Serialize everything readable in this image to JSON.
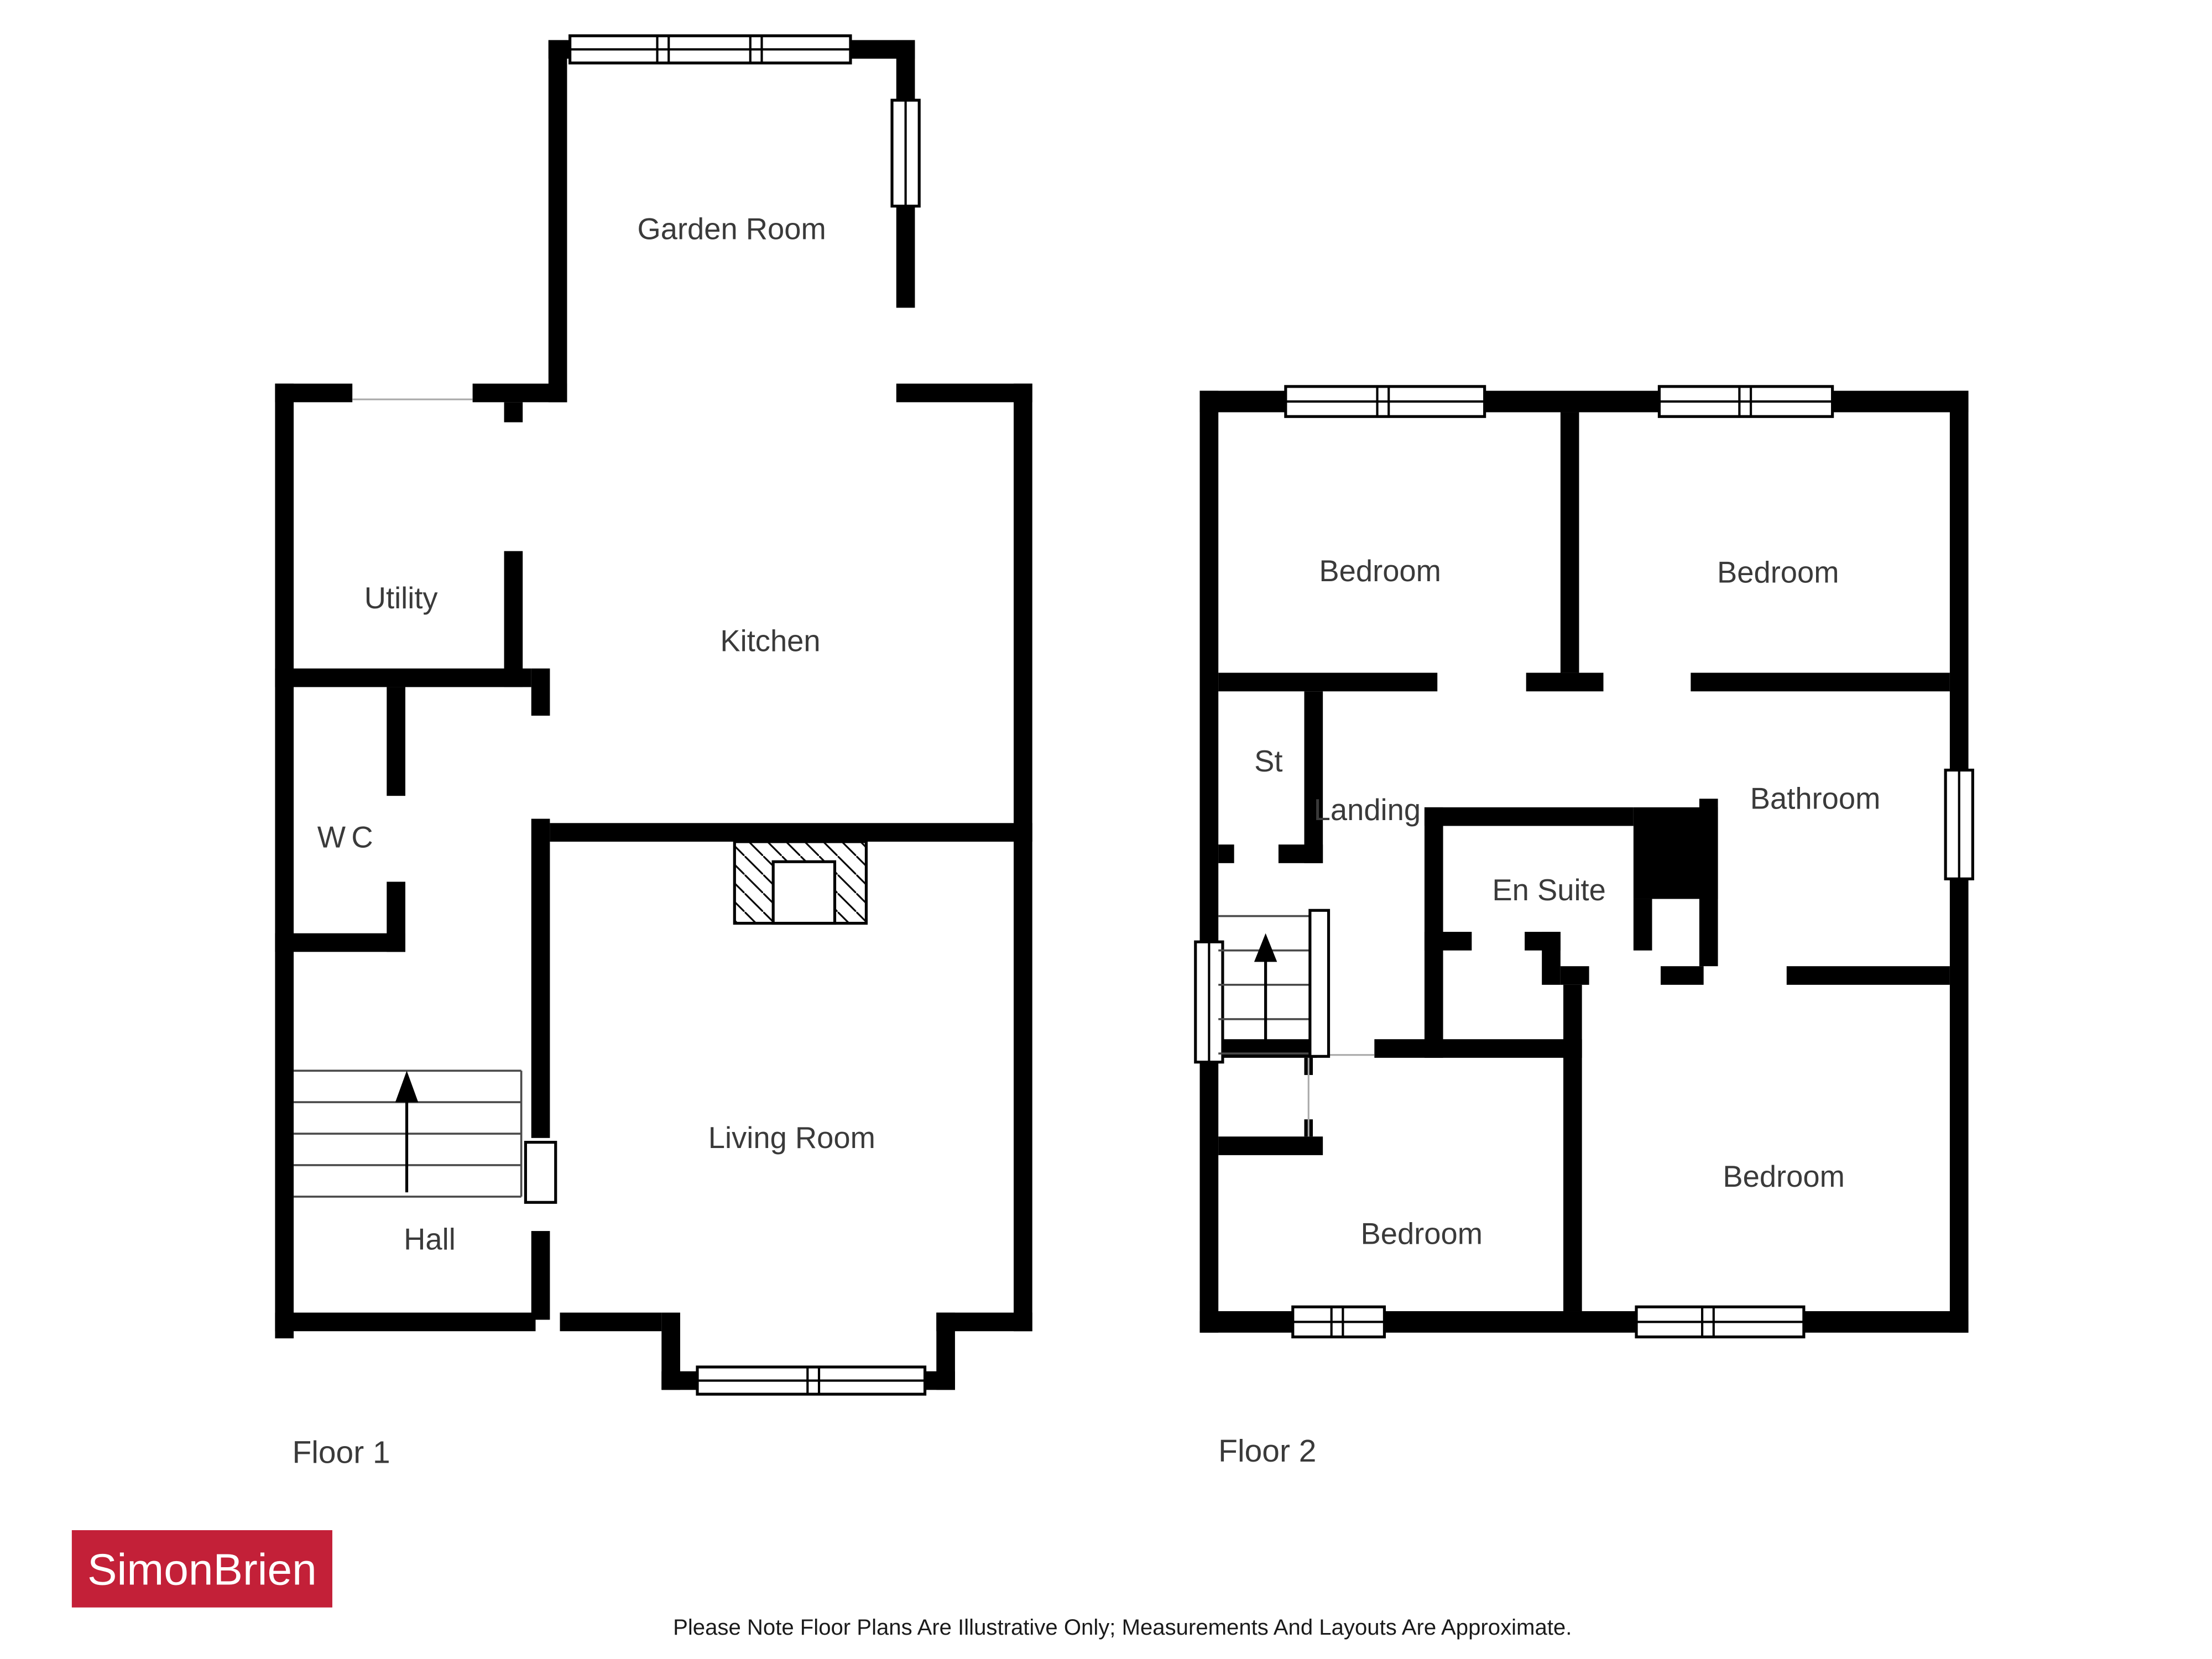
{
  "floor1": {
    "label": "Floor 1",
    "rooms": [
      {
        "name": "Garden Room"
      },
      {
        "name": "Utility"
      },
      {
        "name": "Kitchen"
      },
      {
        "name": "WC"
      },
      {
        "name": "Hall"
      },
      {
        "name": "Living Room"
      }
    ]
  },
  "floor2": {
    "label": "Floor 2",
    "rooms": [
      {
        "name": "Bedroom"
      },
      {
        "name": "Bedroom"
      },
      {
        "name": "St"
      },
      {
        "name": "Landing"
      },
      {
        "name": "Bathroom"
      },
      {
        "name": "En Suite"
      },
      {
        "name": "Bedroom"
      },
      {
        "name": "Bedroom"
      }
    ]
  },
  "branding": {
    "agency_name": "SimonBrien",
    "logo_background": "#c32038",
    "logo_text_color": "#ffffff"
  },
  "footer": {
    "disclaimer": "Please Note Floor Plans Are Illustrative Only; Measurements And Layouts Are Approximate."
  },
  "palette": {
    "wall_color": "#000000",
    "label_color": "#3a3a3a",
    "background": "#ffffff"
  }
}
